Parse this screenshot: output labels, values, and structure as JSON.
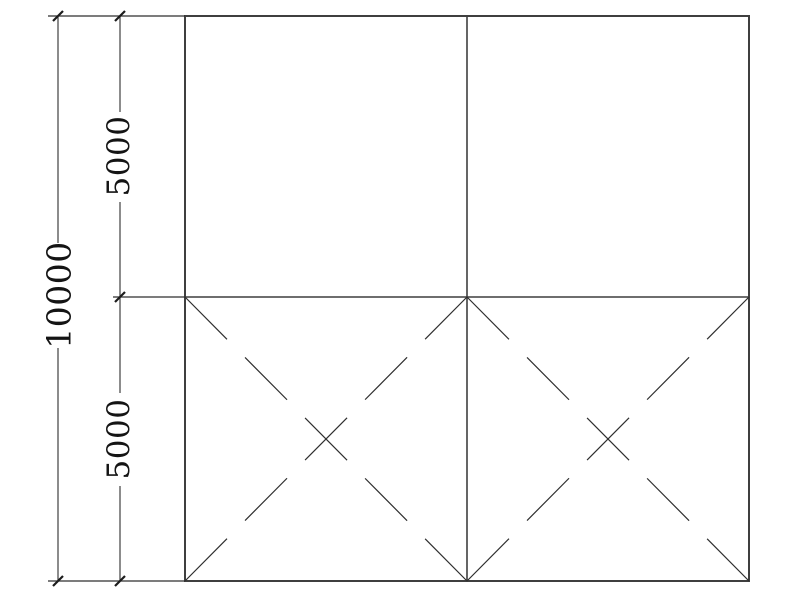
{
  "drawing": {
    "type": "cad-frame-elevation",
    "dimensions": {
      "overall_height": "10000",
      "upper_segment": "5000",
      "lower_segment": "5000"
    },
    "colors": {
      "background": "#ffffff",
      "outline": "#3f3f3f",
      "line": "#2e2e2e",
      "tick": "#1c1c1c",
      "text": "#141414"
    },
    "grid": {
      "rows": 2,
      "columns": 2
    },
    "braced_cells": [
      "bottom-left",
      "bottom-right"
    ]
  }
}
